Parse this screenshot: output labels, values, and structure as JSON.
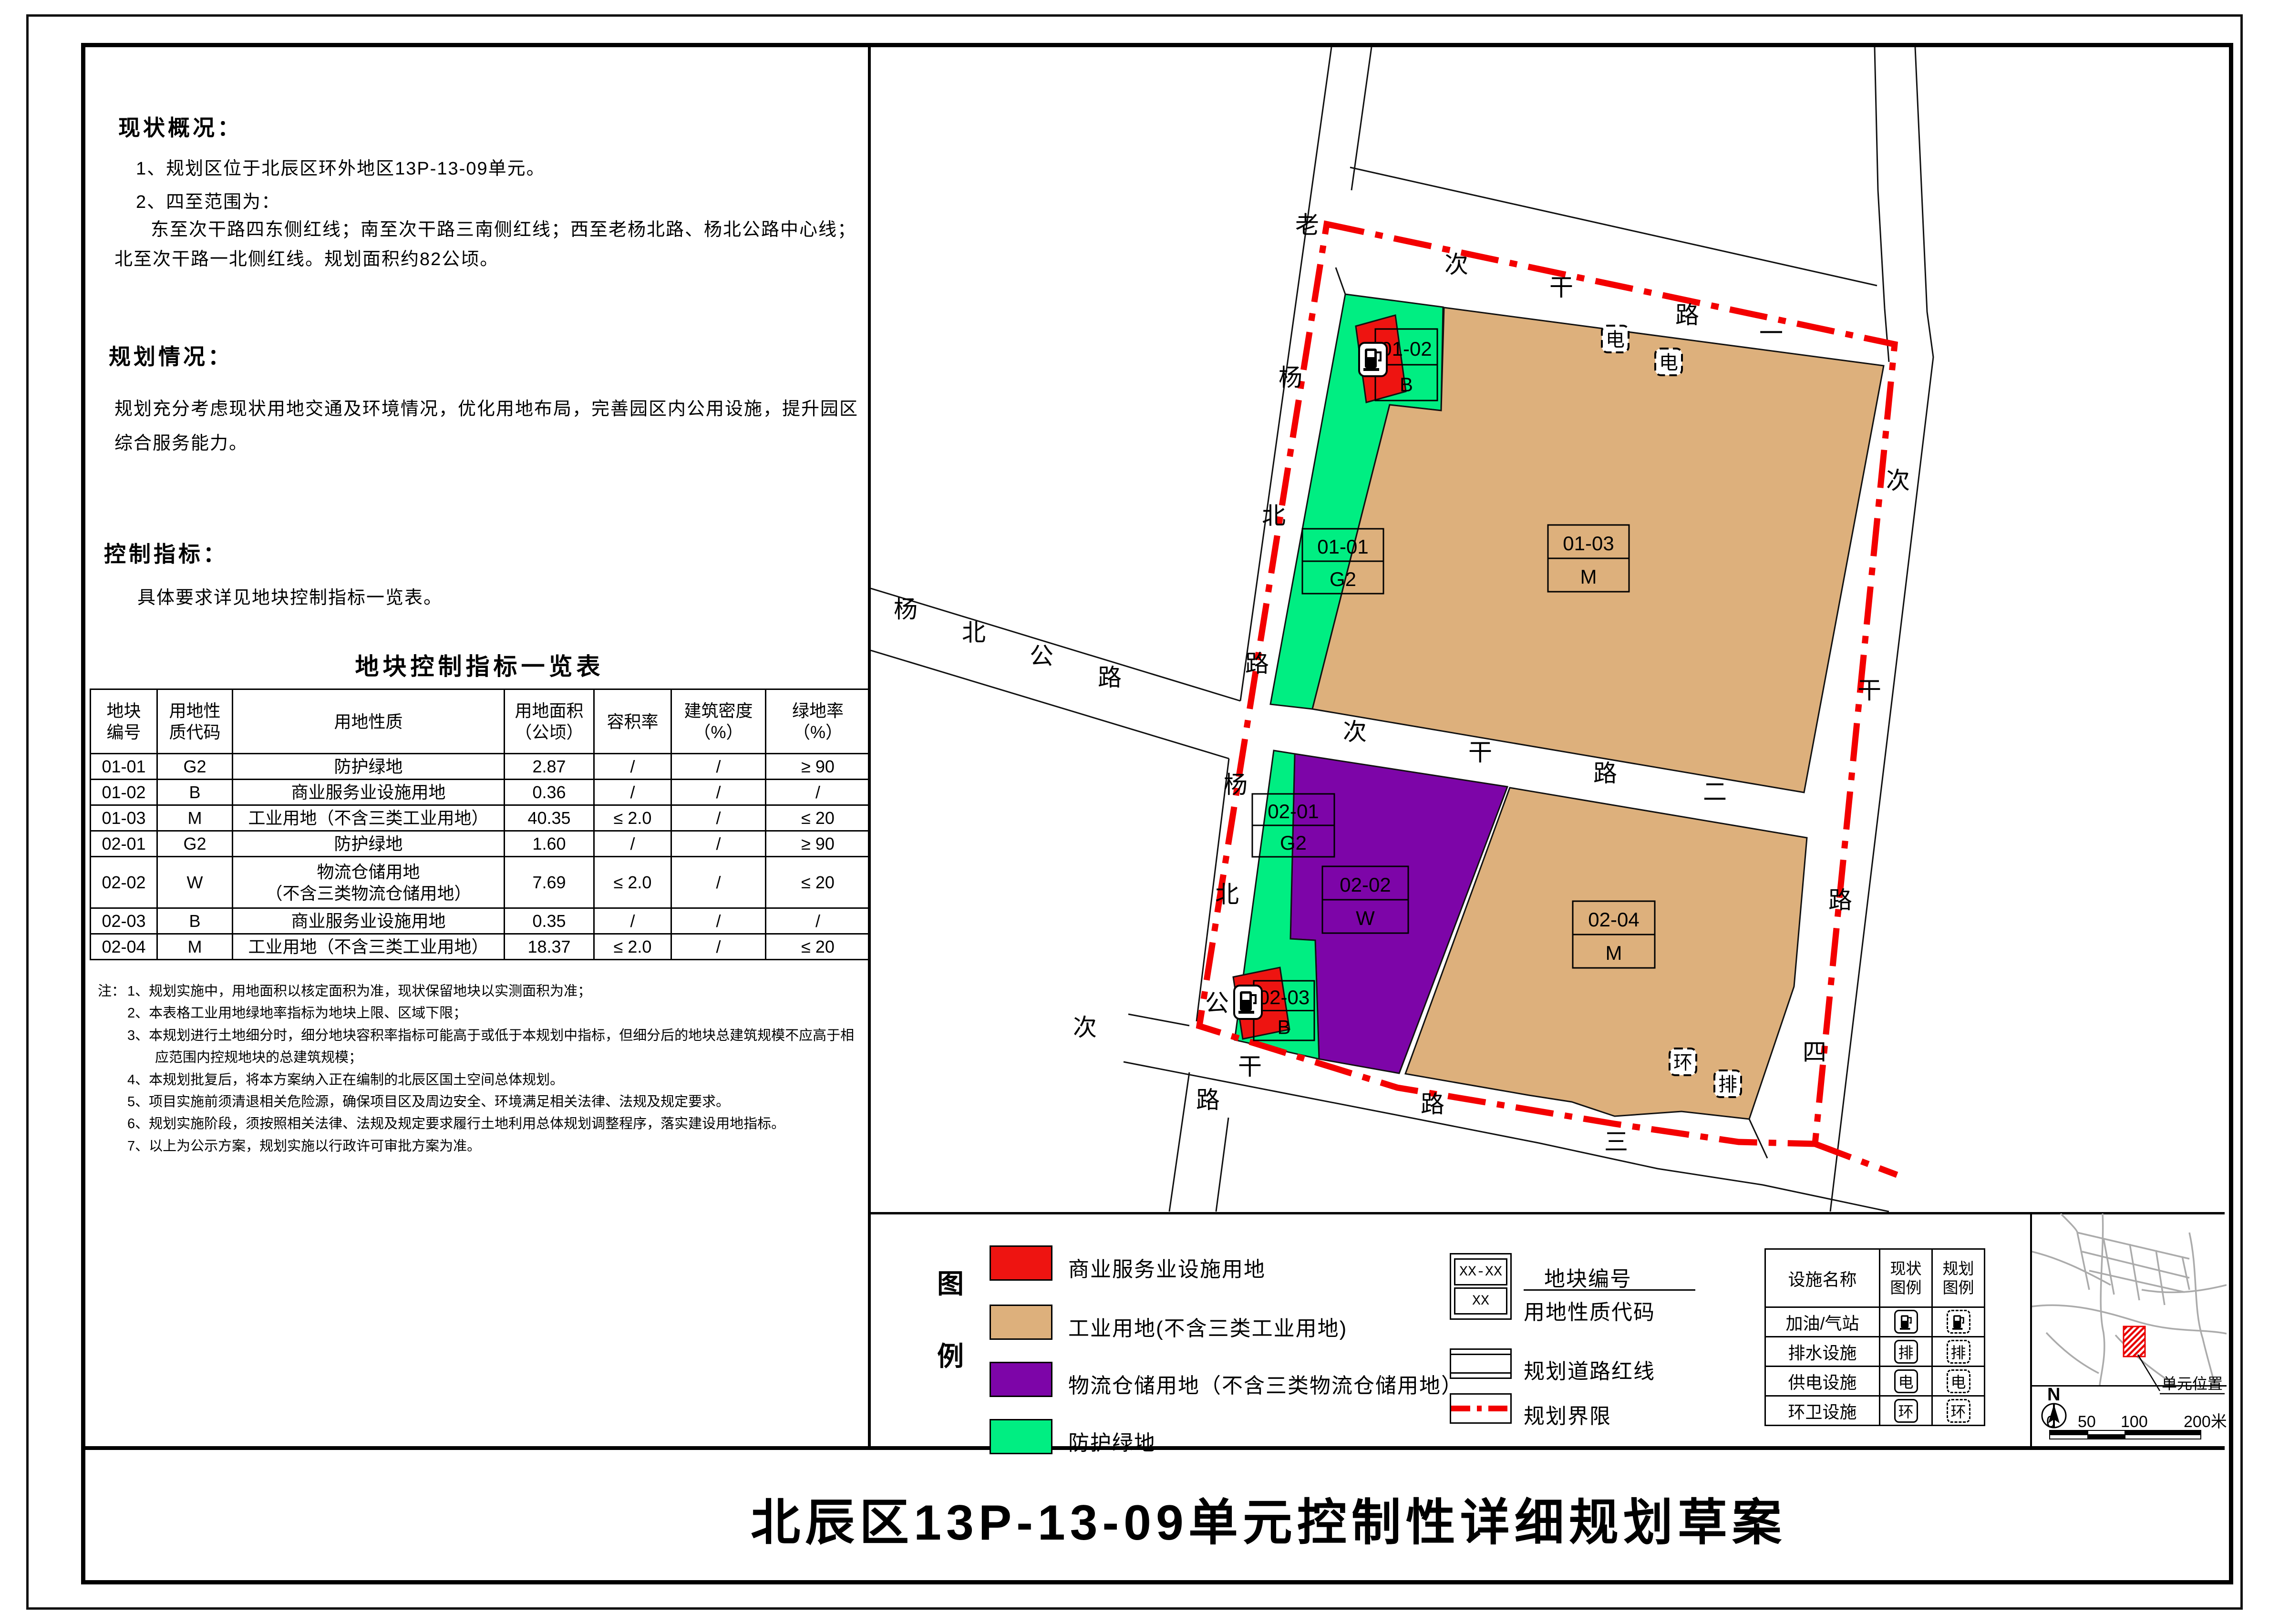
{
  "colors": {
    "commercial": "#ee1411",
    "industrial": "#ddb07c",
    "logistics": "#7d05a8",
    "green": "#00ee82",
    "boundary": "#f30000",
    "inset_road": "#ababab"
  },
  "left_panel": {
    "status": {
      "heading": "现状概况：",
      "item1": "1、规划区位于北辰区环外地区13P-13-09单元。",
      "item2": "2、四至范围为：",
      "item3": "东至次干路四东侧红线；南至次干路三南侧红线；西至老杨北路、杨北公路中心线；北至次干路一北侧红线。规划面积约82公顷。"
    },
    "planning": {
      "heading": "规划情况：",
      "body": "规划充分考虑现状用地交通及环境情况，优化用地布局，完善园区内公用设施，提升园区综合服务能力。"
    },
    "control": {
      "heading": "控制指标：",
      "body": "具体要求详见地块控制指标一览表。"
    },
    "table": {
      "title": "地块控制指标一览表",
      "headers": [
        "地块\n编号",
        "用地性\n质代码",
        "用地性质",
        "用地面积\n（公顷）",
        "容积率",
        "建筑密度\n（%）",
        "绿地率\n（%）"
      ],
      "rows": [
        [
          "01-01",
          "G2",
          "防护绿地",
          "2.87",
          "/",
          "/",
          "≥ 90"
        ],
        [
          "01-02",
          "B",
          "商业服务业设施用地",
          "0.36",
          "/",
          "/",
          "/"
        ],
        [
          "01-03",
          "M",
          "工业用地（不含三类工业用地）",
          "40.35",
          "≤ 2.0",
          "/",
          "≤ 20"
        ],
        [
          "02-01",
          "G2",
          "防护绿地",
          "1.60",
          "/",
          "/",
          "≥ 90"
        ],
        [
          "02-02",
          "W",
          "物流仓储用地\n（不含三类物流仓储用地）",
          "7.69",
          "≤ 2.0",
          "/",
          "≤ 20"
        ],
        [
          "02-03",
          "B",
          "商业服务业设施用地",
          "0.35",
          "/",
          "/",
          "/"
        ],
        [
          "02-04",
          "M",
          "工业用地（不含三类工业用地）",
          "18.37",
          "≤ 2.0",
          "/",
          "≤ 20"
        ]
      ]
    },
    "notes": {
      "prefix": "注：",
      "items": [
        "1、规划实施中，用地面积以核定面积为准，现状保留地块以实测面积为准；",
        "2、本表格工业用地绿地率指标为地块上限、区域下限；",
        "3、本规划进行土地细分时，细分地块容积率指标可能高于或低于本规划中指标，但细分后的地块总建筑规模不应高于相应范围内控规地块的总建筑规模；",
        "4、本规划批复后，将本方案纳入正在编制的北辰区国土空间总体规划。",
        "5、项目实施前须清退相关危险源，确保项目区及周边安全、环境满足相关法律、法规及规定要求。",
        "6、规划实施阶段，须按照相关法律、法规及规定要求履行土地利用总体规划调整程序，落实建设用地指标。",
        "7、以上为公示方案，规划实施以行政许可审批方案为准。"
      ]
    }
  },
  "map": {
    "road_names": [
      {
        "id": "road1",
        "name": "次干路一"
      },
      {
        "id": "road2",
        "name": "次干路二"
      },
      {
        "id": "road3",
        "name": "次干路三"
      },
      {
        "id": "road4",
        "name": "次干路四"
      },
      {
        "id": "laoyang",
        "name": "老杨北路"
      },
      {
        "id": "yangbei_diag",
        "name": "杨北公路"
      },
      {
        "id": "yangbei_south",
        "name": "杨北公路"
      }
    ],
    "parcels": [
      {
        "code": "01-01",
        "use": "G2"
      },
      {
        "code": "01-02",
        "use": "B"
      },
      {
        "code": "01-03",
        "use": "M"
      },
      {
        "code": "02-01",
        "use": "G2"
      },
      {
        "code": "02-02",
        "use": "W"
      },
      {
        "code": "02-03",
        "use": "B"
      },
      {
        "code": "02-04",
        "use": "M"
      }
    ],
    "facility_marks": [
      {
        "glyph": "fuel",
        "status": "existing"
      },
      {
        "glyph": "fuel",
        "status": "existing"
      },
      {
        "glyph": "电",
        "status": "planned"
      },
      {
        "glyph": "电",
        "status": "planned"
      },
      {
        "glyph": "环",
        "status": "planned"
      },
      {
        "glyph": "排",
        "status": "planned"
      }
    ]
  },
  "legend": {
    "title": "图例",
    "landuse_items": [
      {
        "label": "商业服务业设施用地",
        "color_key": "commercial"
      },
      {
        "label": "工业用地(不含三类工业用地)",
        "color_key": "industrial"
      },
      {
        "label": "物流仓储用地（不含三类物流仓储用地）",
        "color_key": "logistics"
      },
      {
        "label": "防护绿地",
        "color_key": "green"
      }
    ],
    "parcel_sample": {
      "top": "XX-XX",
      "bottom": "XX",
      "label_top": "地块编号",
      "label_bottom": "用地性质代码"
    },
    "road_redline_label": "规划道路红线",
    "boundary_label": "规划界限"
  },
  "facilities_table": {
    "headers": [
      "设施名称",
      "现状\n图例",
      "规划\n图例"
    ],
    "rows": [
      {
        "name": "加油/气站",
        "glyph": "fuel"
      },
      {
        "name": "排水设施",
        "glyph": "排"
      },
      {
        "name": "供电设施",
        "glyph": "电"
      },
      {
        "name": "环卫设施",
        "glyph": "环"
      }
    ]
  },
  "inset": {
    "callout": "单元位置",
    "north": "N",
    "scale_ticks": [
      "0",
      "50",
      "100",
      "200米"
    ]
  },
  "title_bar": {
    "title": "北辰区13P-13-09单元控制性详细规划草案"
  }
}
